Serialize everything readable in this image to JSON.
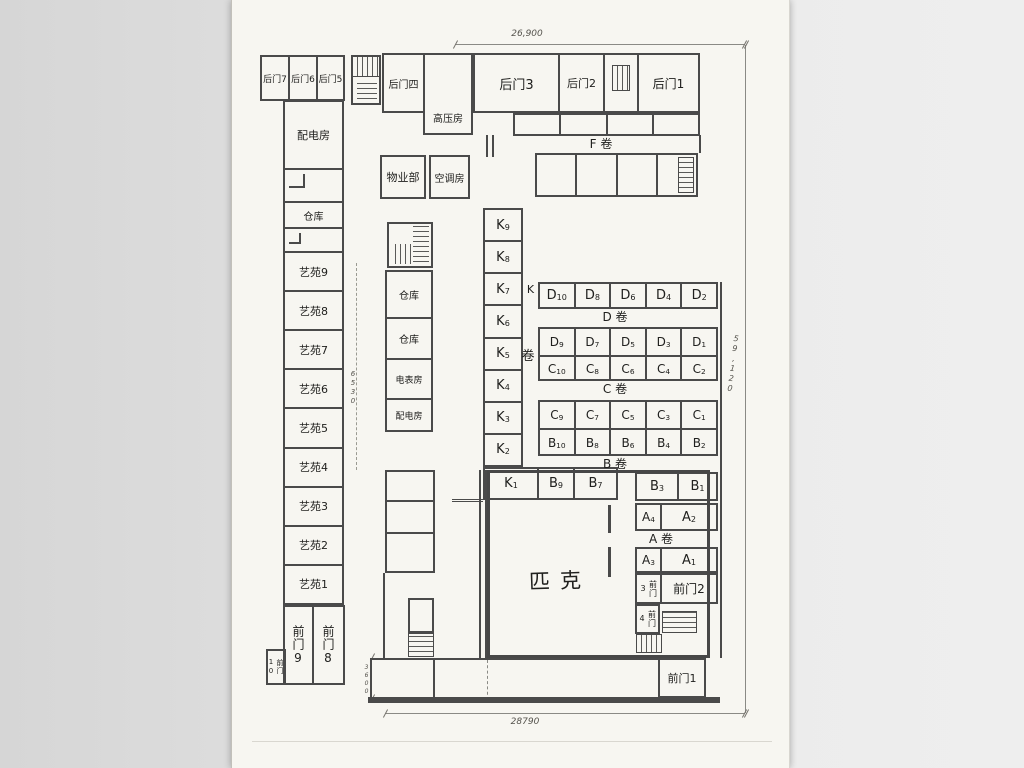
{
  "dims": {
    "top": "26,900",
    "right": "59,120",
    "bottom": "28790",
    "mid_left": "6530",
    "bottom_left": "3600"
  },
  "top_band": {
    "bd7": "后门7",
    "bd6": "后门6",
    "bd5": "后门5",
    "bd4": "后门四",
    "gaoya": "高压房",
    "bd3": "后门3",
    "bd2": "后门2",
    "bd1": "后门1"
  },
  "left_wing": {
    "peidian": "配电房",
    "cangku": "仓库",
    "yiyuan": [
      "艺苑9",
      "艺苑8",
      "艺苑7",
      "艺苑6",
      "艺苑5",
      "艺苑4",
      "艺苑3",
      "艺苑2",
      "艺苑1"
    ],
    "fm9": "前门9",
    "fm8": "前门8",
    "fm10": "前门10"
  },
  "mid_wing": {
    "wuye": "物业部",
    "kongtiao": "空调房",
    "cangku_a": "仓库",
    "cangku_b": "仓库",
    "dianbiao": "电表房",
    "peidian": "配电房"
  },
  "sections": {
    "f": "F 卷",
    "d": "D 卷",
    "c": "C 卷",
    "b": "B 卷",
    "a": "A 卷",
    "k_letter": "K",
    "k_juan": "卷"
  },
  "units": {
    "k": [
      "K9",
      "K8",
      "K7",
      "K6",
      "K5",
      "K4",
      "K3",
      "K2"
    ],
    "k1_row": [
      "K1",
      "B9",
      "B7"
    ],
    "d_even": [
      "D10",
      "D8",
      "D6",
      "D4",
      "D2"
    ],
    "d_odd": [
      "D9",
      "D7",
      "D5",
      "D3",
      "D1"
    ],
    "c_even": [
      "C10",
      "C8",
      "C6",
      "C4",
      "C2"
    ],
    "c_odd": [
      "C9",
      "C7",
      "C5",
      "C3",
      "C1"
    ],
    "b_even": [
      "B10",
      "B8",
      "B6",
      "B4",
      "B2"
    ],
    "b_odd_right": [
      "B3",
      "B1"
    ],
    "a_even": [
      "A4",
      "A2"
    ],
    "a_odd": [
      "A3",
      "A1"
    ]
  },
  "front_doors": {
    "fm1": "前门1",
    "fm2": "前门2",
    "fm3": "前门3",
    "fm4": "前门4"
  },
  "hall": {
    "name": "匹克"
  }
}
